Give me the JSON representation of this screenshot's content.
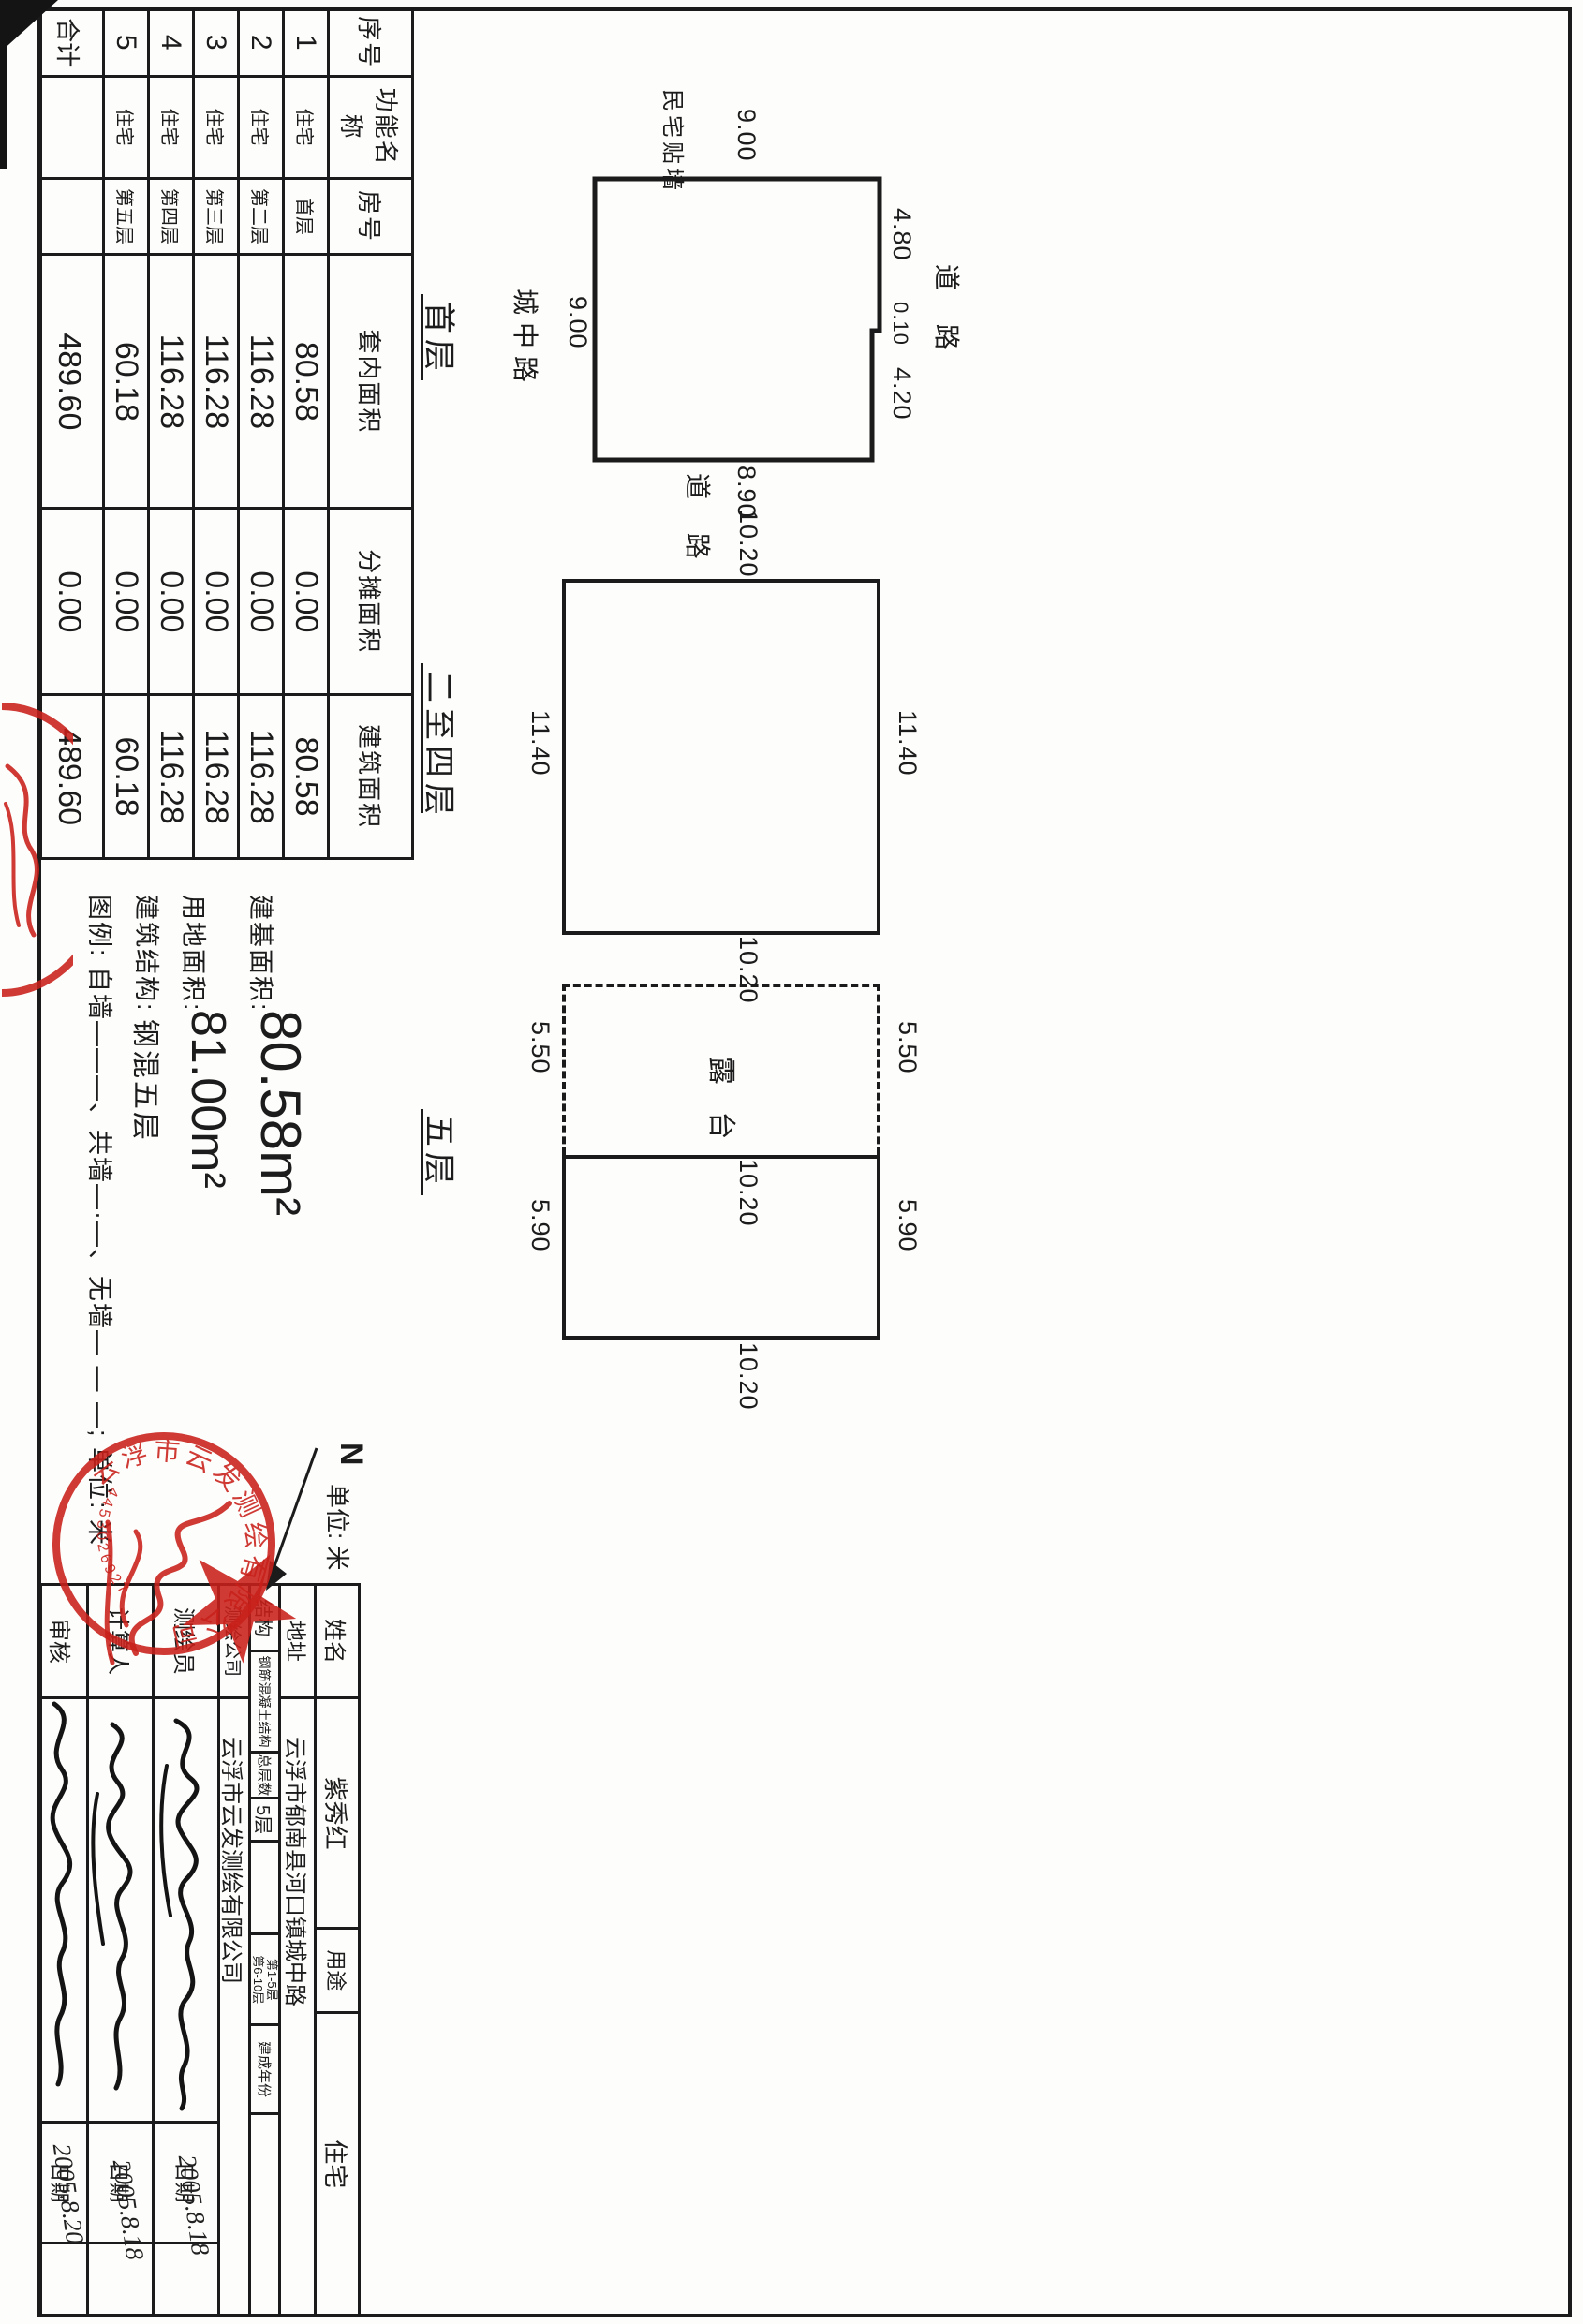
{
  "area_table": {
    "headers": [
      "序号",
      "功能名称",
      "房号",
      "套内面积",
      "分摊面积",
      "建筑面积"
    ],
    "rows": [
      [
        "1",
        "住宅",
        "首层",
        "80.58",
        "0.00",
        "80.58"
      ],
      [
        "2",
        "住宅",
        "第二层",
        "116.28",
        "0.00",
        "116.28"
      ],
      [
        "3",
        "住宅",
        "第三层",
        "116.28",
        "0.00",
        "116.28"
      ],
      [
        "4",
        "住宅",
        "第四层",
        "116.28",
        "0.00",
        "116.28"
      ],
      [
        "5",
        "住宅",
        "第五层",
        "60.18",
        "0.00",
        "60.18"
      ],
      [
        "合计",
        "",
        "",
        "489.60",
        "0.00",
        "489.60"
      ]
    ]
  },
  "summary": {
    "line1_label": "建基面积:",
    "line1_value": "80.58m²",
    "line2_label": "用地面积:",
    "line2_value": "81.00m²",
    "line3_label": "建筑结构:",
    "line3_value": "钢混五层",
    "legend": "图例: 自墙———、共墙—·—、无墙— — —; 单位: 米"
  },
  "plans": {
    "floor1": {
      "label": "首层",
      "neighbor": "民宅贴墙",
      "roads": {
        "top": "道 路",
        "right": "道 路",
        "bottom": "城中路"
      }
    },
    "floor2to4": {
      "label": "二至四层"
    },
    "floor5": {
      "label": "五层",
      "terrace": "露 台"
    }
  },
  "dim_labels": [
    {
      "id": "f1-top-left",
      "text": "4.80"
    },
    {
      "id": "f1-top-mid",
      "text": "0.10"
    },
    {
      "id": "f1-top-right",
      "text": "4.20"
    },
    {
      "id": "f1-left",
      "text": "9.00"
    },
    {
      "id": "f1-right",
      "text": "8.90"
    },
    {
      "id": "f1-bottom",
      "text": "9.00"
    },
    {
      "id": "f2-top",
      "text": "11.40"
    },
    {
      "id": "f2-bottom",
      "text": "11.40"
    },
    {
      "id": "f2-left",
      "text": "10.20"
    },
    {
      "id": "f2-right",
      "text": "10.20"
    },
    {
      "id": "f3-top-left",
      "text": "5.50"
    },
    {
      "id": "f3-top-right",
      "text": "5.90"
    },
    {
      "id": "f3-bottom-left",
      "text": "5.50"
    },
    {
      "id": "f3-bottom-right",
      "text": "5.90"
    },
    {
      "id": "f3-mid",
      "text": "10.20"
    },
    {
      "id": "f3-right",
      "text": "10.20"
    }
  ],
  "info_table": {
    "rows": [
      [
        "姓名",
        "紫秀红",
        "用途",
        "住宅"
      ],
      [
        "地址",
        "云浮市郁南县河口镇城中路"
      ],
      [
        "结构",
        "钢筋混凝土结构",
        "总层数",
        "5层",
        "",
        "第1-5层\n第6-10层",
        "建成年份",
        ""
      ],
      [
        "测绘公司",
        "云浮市云发测绘有限公司"
      ],
      [
        "测绘员",
        "",
        "日期",
        ""
      ],
      [
        "计算人",
        "",
        "日期",
        ""
      ],
      [
        "审核",
        "",
        "日期",
        ""
      ]
    ],
    "dates": [
      "2005.8.18",
      "2005.8.18",
      "2005.8.20"
    ]
  },
  "compass": {
    "north": "N",
    "unit": "单位: 米"
  },
  "stamp": {
    "company": "云浮市云发测绘有限公司",
    "number": "4453026927"
  },
  "colors": {
    "ink": "#1b1b1b",
    "red": "#c9201a"
  }
}
